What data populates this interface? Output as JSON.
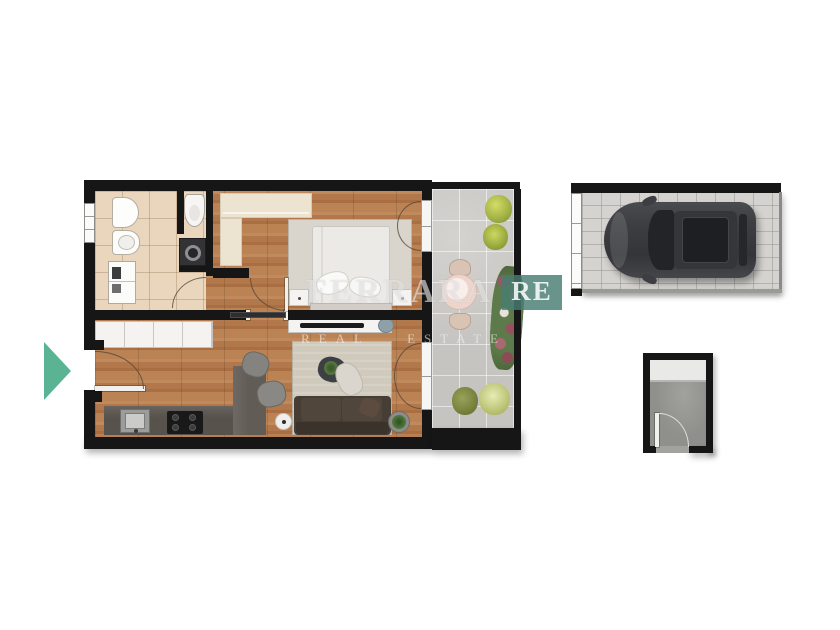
{
  "watermark": {
    "brand": "FERRARA",
    "badge": "RE",
    "tagline_left": "REAL",
    "tagline_right": "ESTATE"
  },
  "indicator": {
    "name": "entrance-arrow",
    "direction": "right",
    "color": "#5ab392"
  },
  "colors": {
    "wall": "#161616",
    "wood_floor": "#b2784b",
    "bath_tile": "#e9d6bd",
    "balcony_paver": "#c6c4c0",
    "garage_floor": "#d5d3cf",
    "storage_floor": "#8f8f8b",
    "wardrobe_cream": "#ece3d0",
    "living_rug": "#d0cabd",
    "sofa_brown": "#463d35",
    "kitchen_counter": "#57524c",
    "car_body": "#3d3e41",
    "watermark_teal": "#487c72",
    "arrow_teal": "#5ab392"
  },
  "floor_plan": {
    "areas": [
      "bathroom",
      "walk-in-closet",
      "bedroom",
      "corridor",
      "kitchen-living-room",
      "balcony",
      "garage",
      "cellar"
    ],
    "bathroom_items": [
      "bidet",
      "washbasin",
      "storage-column",
      "toilet",
      "washing-machine",
      "window"
    ],
    "bedroom_items": [
      "wardrobe-l-shaped",
      "double-bed",
      "pillows",
      "rug",
      "nightstand-left",
      "nightstand-right",
      "french-door-to-balcony"
    ],
    "living_items": [
      "tv-console",
      "tv",
      "kitchen-cabinet-row",
      "kitchen-counter",
      "sink",
      "cooktop-4-burners",
      "peninsula",
      "bar-stool",
      "bar-stool",
      "side-table",
      "rug",
      "coffee-table-with-plant",
      "chaise",
      "sofa",
      "potted-plant",
      "entrance-door",
      "french-door-to-balcony"
    ],
    "balcony_items": [
      "bush",
      "bush",
      "bistro-table",
      "chair",
      "chair",
      "flowering-shrub",
      "bush",
      "bush"
    ],
    "garage_items": [
      "sectional-door",
      "car-top-view"
    ],
    "cellar_items": [
      "shelf",
      "door"
    ]
  }
}
